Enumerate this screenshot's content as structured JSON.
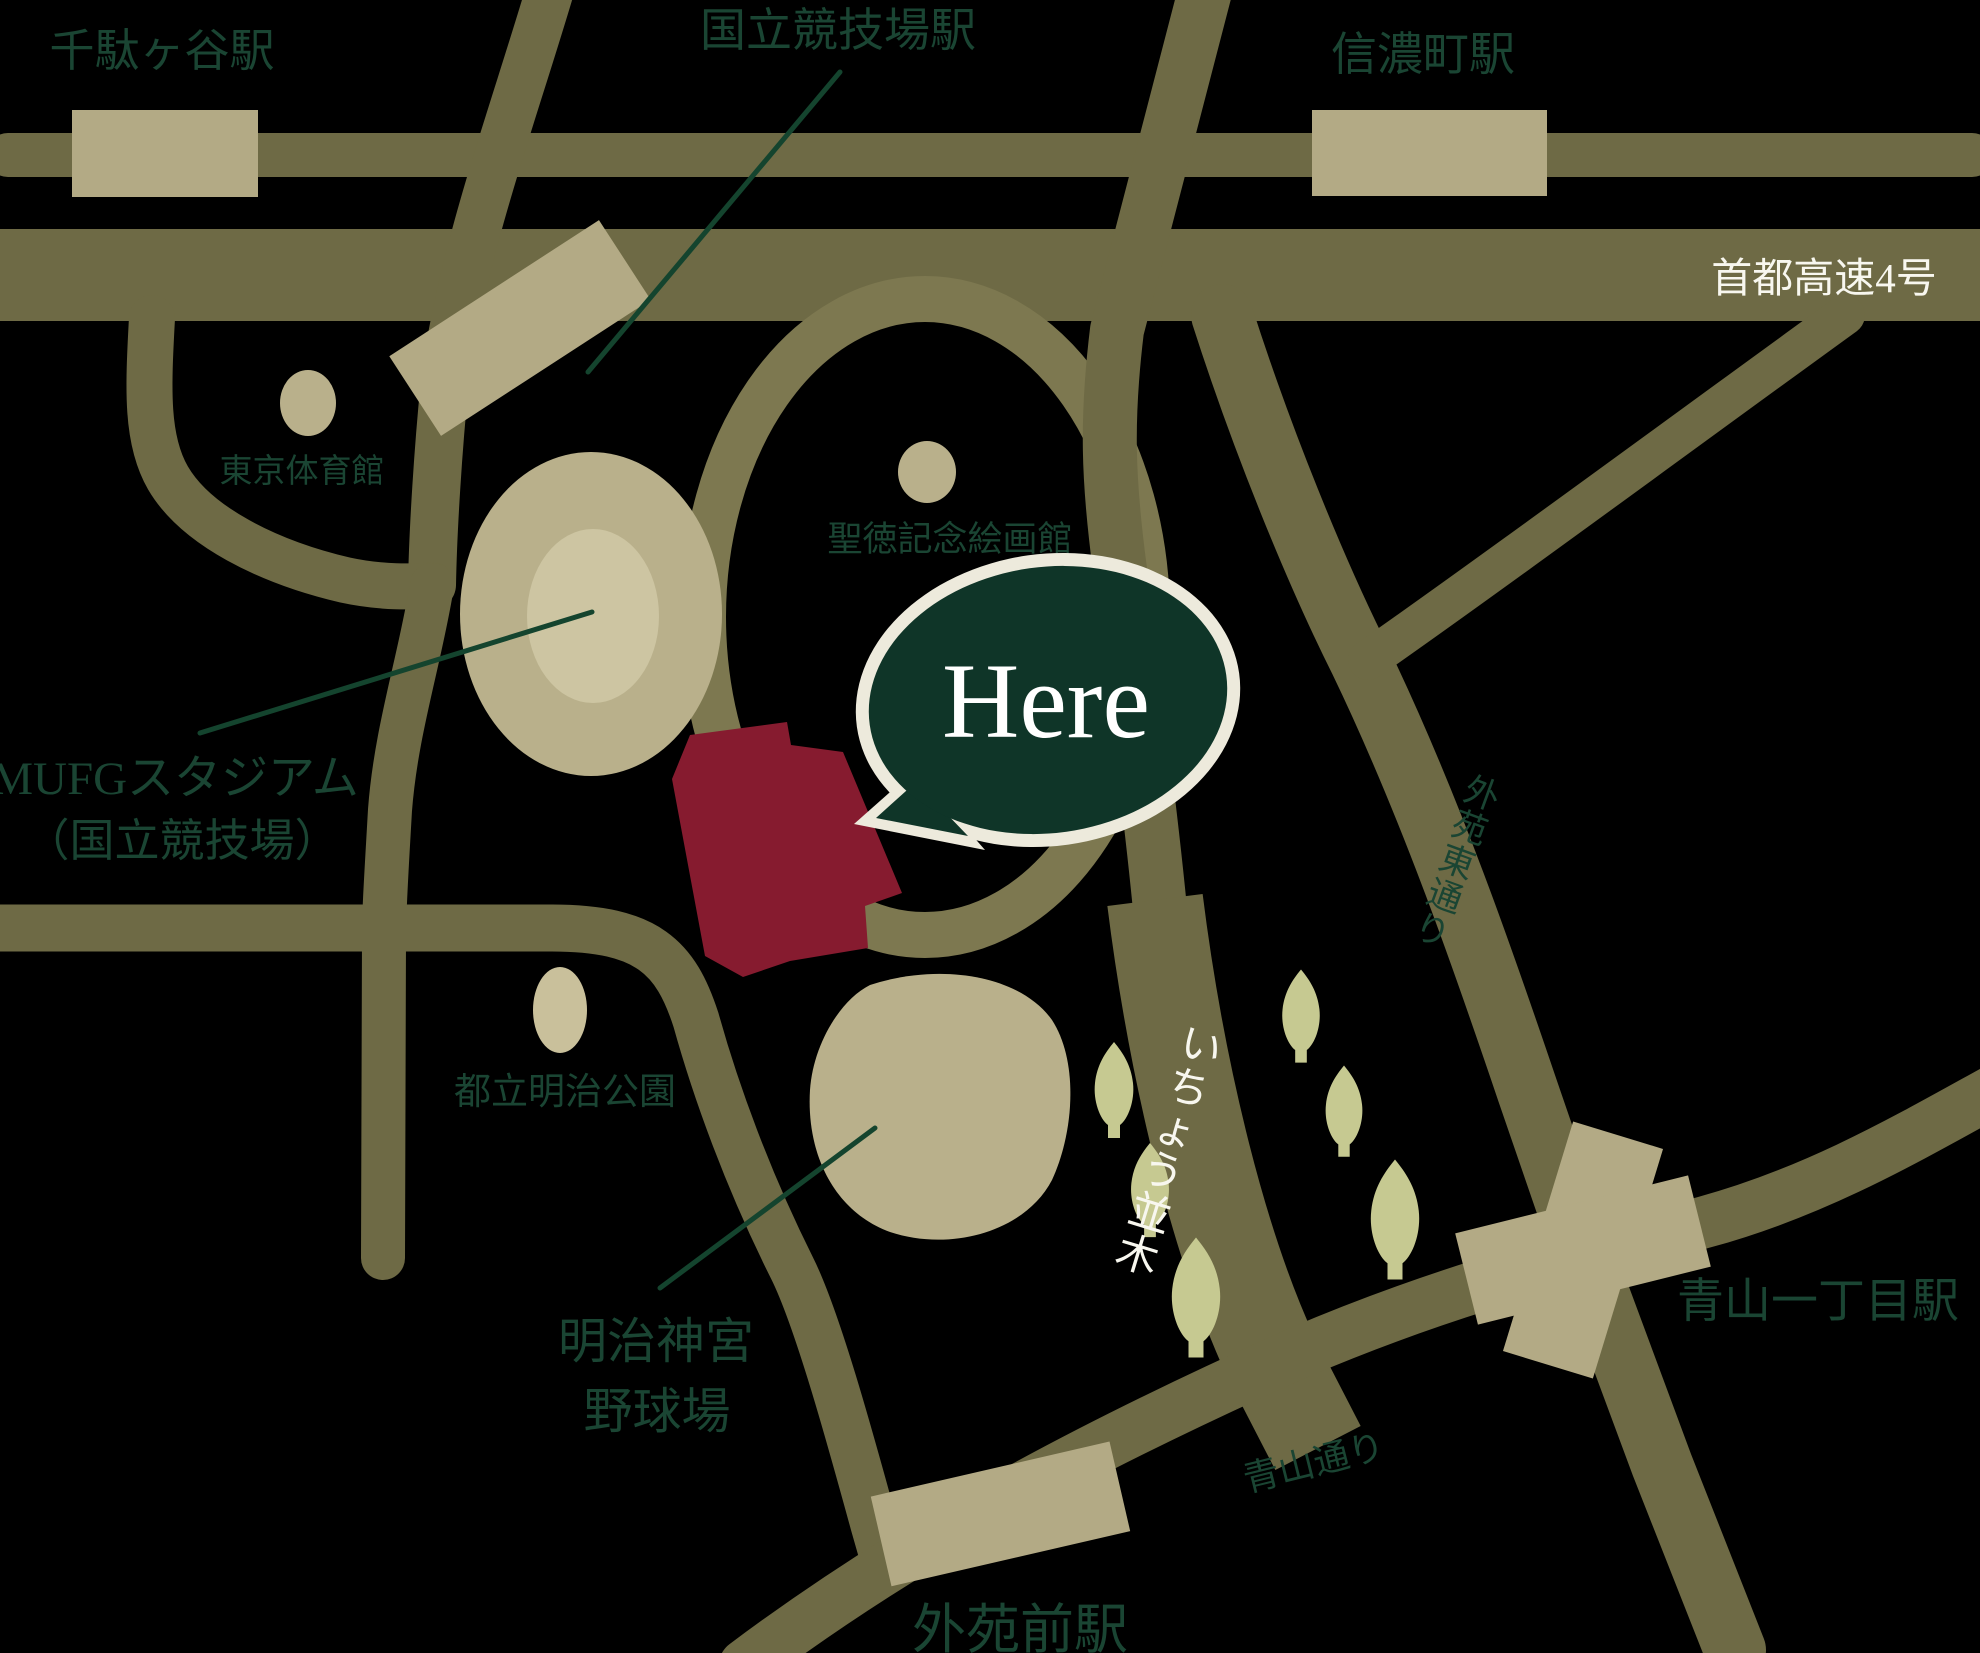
{
  "colors": {
    "background": "#000000",
    "road": "#6e6a45",
    "road_light": "#7d7850",
    "station_fill": "#b3aa85",
    "landmark_fill": "#b9b08b",
    "landmark_fill_light": "#cdc5a2",
    "park_fill": "#c9c09b",
    "tree_fill": "#c6c991",
    "building_red": "#861b2f",
    "label_green": "#1a4533",
    "label_white": "#f8f7ef",
    "bubble_fill": "#0f3528",
    "bubble_border": "#edeadc",
    "bubble_text": "#ffffff",
    "leader_line": "#14442e"
  },
  "stations": {
    "sendagaya": {
      "label": "千駄ヶ谷駅"
    },
    "kokuritsu_kyogijo": {
      "label": "国立競技場駅"
    },
    "shinanomachi": {
      "label": "信濃町駅"
    },
    "aoyama_itchome": {
      "label": "青山一丁目駅"
    },
    "gaienmae": {
      "label": "外苑前駅"
    }
  },
  "roads": {
    "shuto_expressway": {
      "label": "首都高速4号"
    },
    "icho_namiki": {
      "label": "いちょう並木"
    },
    "gaien_higashi_dori": {
      "label": "外苑東通り"
    },
    "aoyama_dori": {
      "label": "青山通り"
    }
  },
  "landmarks": {
    "tokyo_gymnasium": {
      "label": "東京体育館"
    },
    "seitoku_gallery": {
      "label": "聖徳記念絵画館"
    },
    "mufg_stadium": {
      "label_line1": "MUFGスタジアム",
      "label_line2": "（国立競技場）"
    },
    "meiji_park": {
      "label": "都立明治公園"
    },
    "jingu_baseball": {
      "label_line1": "明治神宮",
      "label_line2": "野球場"
    }
  },
  "marker": {
    "label": "Here"
  }
}
